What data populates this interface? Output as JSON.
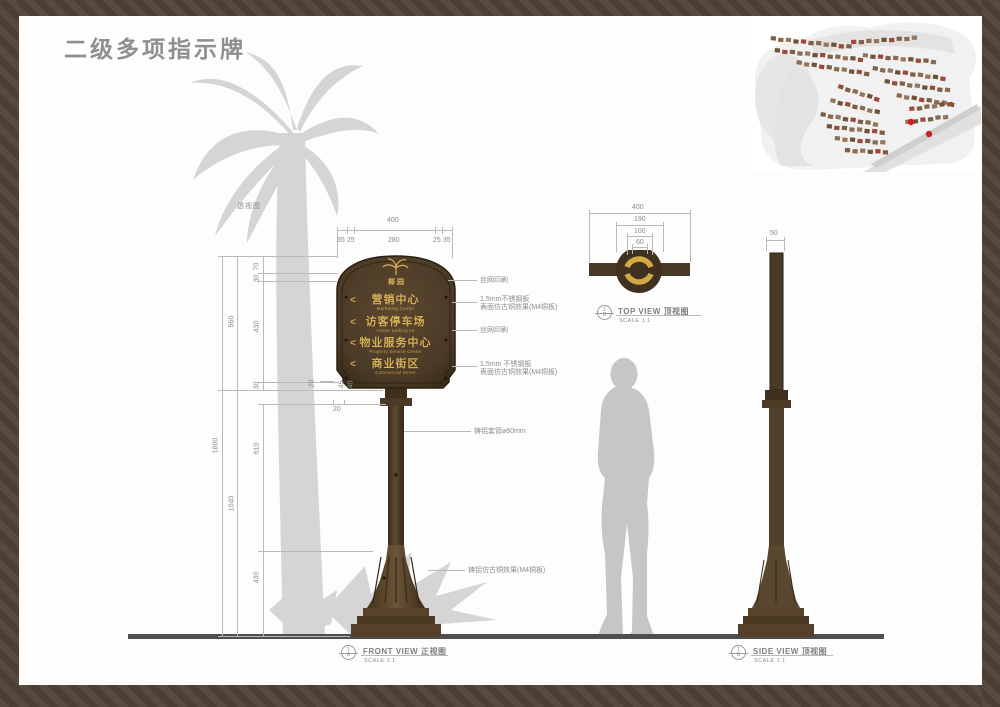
{
  "page": {
    "title": "二级多项指示牌",
    "scene_label": "透视图"
  },
  "sign": {
    "logo_text": "椰园",
    "rows": [
      {
        "arrow": "<",
        "zh": "营销中心",
        "en": "Marketing Center"
      },
      {
        "arrow": "<",
        "zh": "访客停车场",
        "en": "Visitor parking lot"
      },
      {
        "arrow": "<",
        "zh": "物业服务中心",
        "en": "Property Service Center"
      },
      {
        "arrow": "<",
        "zh": "商业街区",
        "en": "Commercial Street"
      }
    ]
  },
  "annotations": {
    "a1": "丝网印刷",
    "a2_line1": "1.5mm不锈钢板",
    "a2_line2": "表面仿古铜效果(M4铜板)",
    "a3": "丝网印刷",
    "a4_line1": "1.5mm 不锈钢板",
    "a4_line2": "表面仿古铜效果(M4铜板)",
    "a5": "铸铝套管⌀60mm",
    "a6": "铸铝仿古铜效果(M4铜板)"
  },
  "dimensions": {
    "front_width": {
      "total": "400",
      "seg1": "35",
      "seg2": "25",
      "seg3": "280",
      "seg4": "25",
      "seg5": "35"
    },
    "front_height": {
      "total": "1600",
      "panel": "560",
      "below": "1040",
      "s1": "70",
      "s2": "30",
      "s3": "430",
      "s4": "30",
      "pole": "610",
      "base": "430",
      "b1": "20",
      "b2": "45",
      "b3": "40",
      "b4": "20"
    },
    "top_view": {
      "d1": "400",
      "d2": "190",
      "d3": "100",
      "d4": "60"
    },
    "side_view": {
      "w": "50"
    }
  },
  "views": {
    "front": {
      "num": "1",
      "letter": "A",
      "en": "FRONT VIEW",
      "zh": "正视图",
      "scale": "SCALE 1:1"
    },
    "top": {
      "num": "1",
      "letter": "B",
      "en": "TOP VIEW",
      "zh": "顶视图",
      "scale": "SCALE 1:1"
    },
    "side": {
      "num": "1",
      "letter": "B",
      "en": "SIDE VIEW",
      "zh": "顶视图",
      "scale": "SCALE 1:1"
    }
  },
  "colors": {
    "frame_brown": "#4f4236",
    "sign_brown": "#4a3a26",
    "accent_gold": "#cfa750",
    "marker_red": "#cc2020",
    "silhouette_gray": "#d5d5d5",
    "person_gray": "#c6c6c6",
    "ground_gray": "#4e4e4e",
    "title_gray": "#8f8f8f",
    "map_house_browns": [
      "#7d5f45",
      "#8a6a50",
      "#96765a",
      "#6f523c",
      "#9c4a3a"
    ]
  }
}
